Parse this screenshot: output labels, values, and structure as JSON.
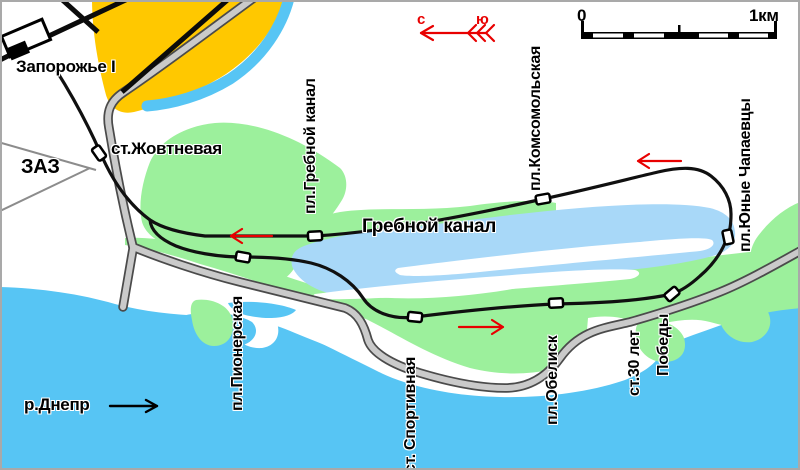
{
  "map": {
    "places": {
      "zaporozhye": "Запорожье I",
      "zaz": "ЗАЗ"
    },
    "water": {
      "canal": "Гребной канал",
      "river": "р.Днепр"
    },
    "stations": {
      "zhovtnevaya": "ст.Жовтневая",
      "grebnoy_kanal": "пл.Гребной канал",
      "komsomolskaya": "пл.Комсомольская",
      "yunye_chapaevtsy": "пл.Юные Чапаевцы",
      "pionerskaya": "пл.Пионерская",
      "sportivnaya": "ст. Спортивная",
      "obelisk": "пл.Обелиск",
      "let30_pobedy_line1": "ст.30 лет",
      "let30_pobedy_line2": "Победы"
    },
    "compass": {
      "north": "с",
      "south": "ю"
    },
    "scale": {
      "start": "0",
      "end": "1км"
    },
    "colors": {
      "river_water": "#57c5f4",
      "canal_water": "#a8d8f8",
      "parkland_green": "#9cf09c",
      "urban_orange": "#ffc800",
      "road_gray": "#cacaca",
      "route_black": "#101010",
      "arrow_red": "#e80000"
    }
  }
}
